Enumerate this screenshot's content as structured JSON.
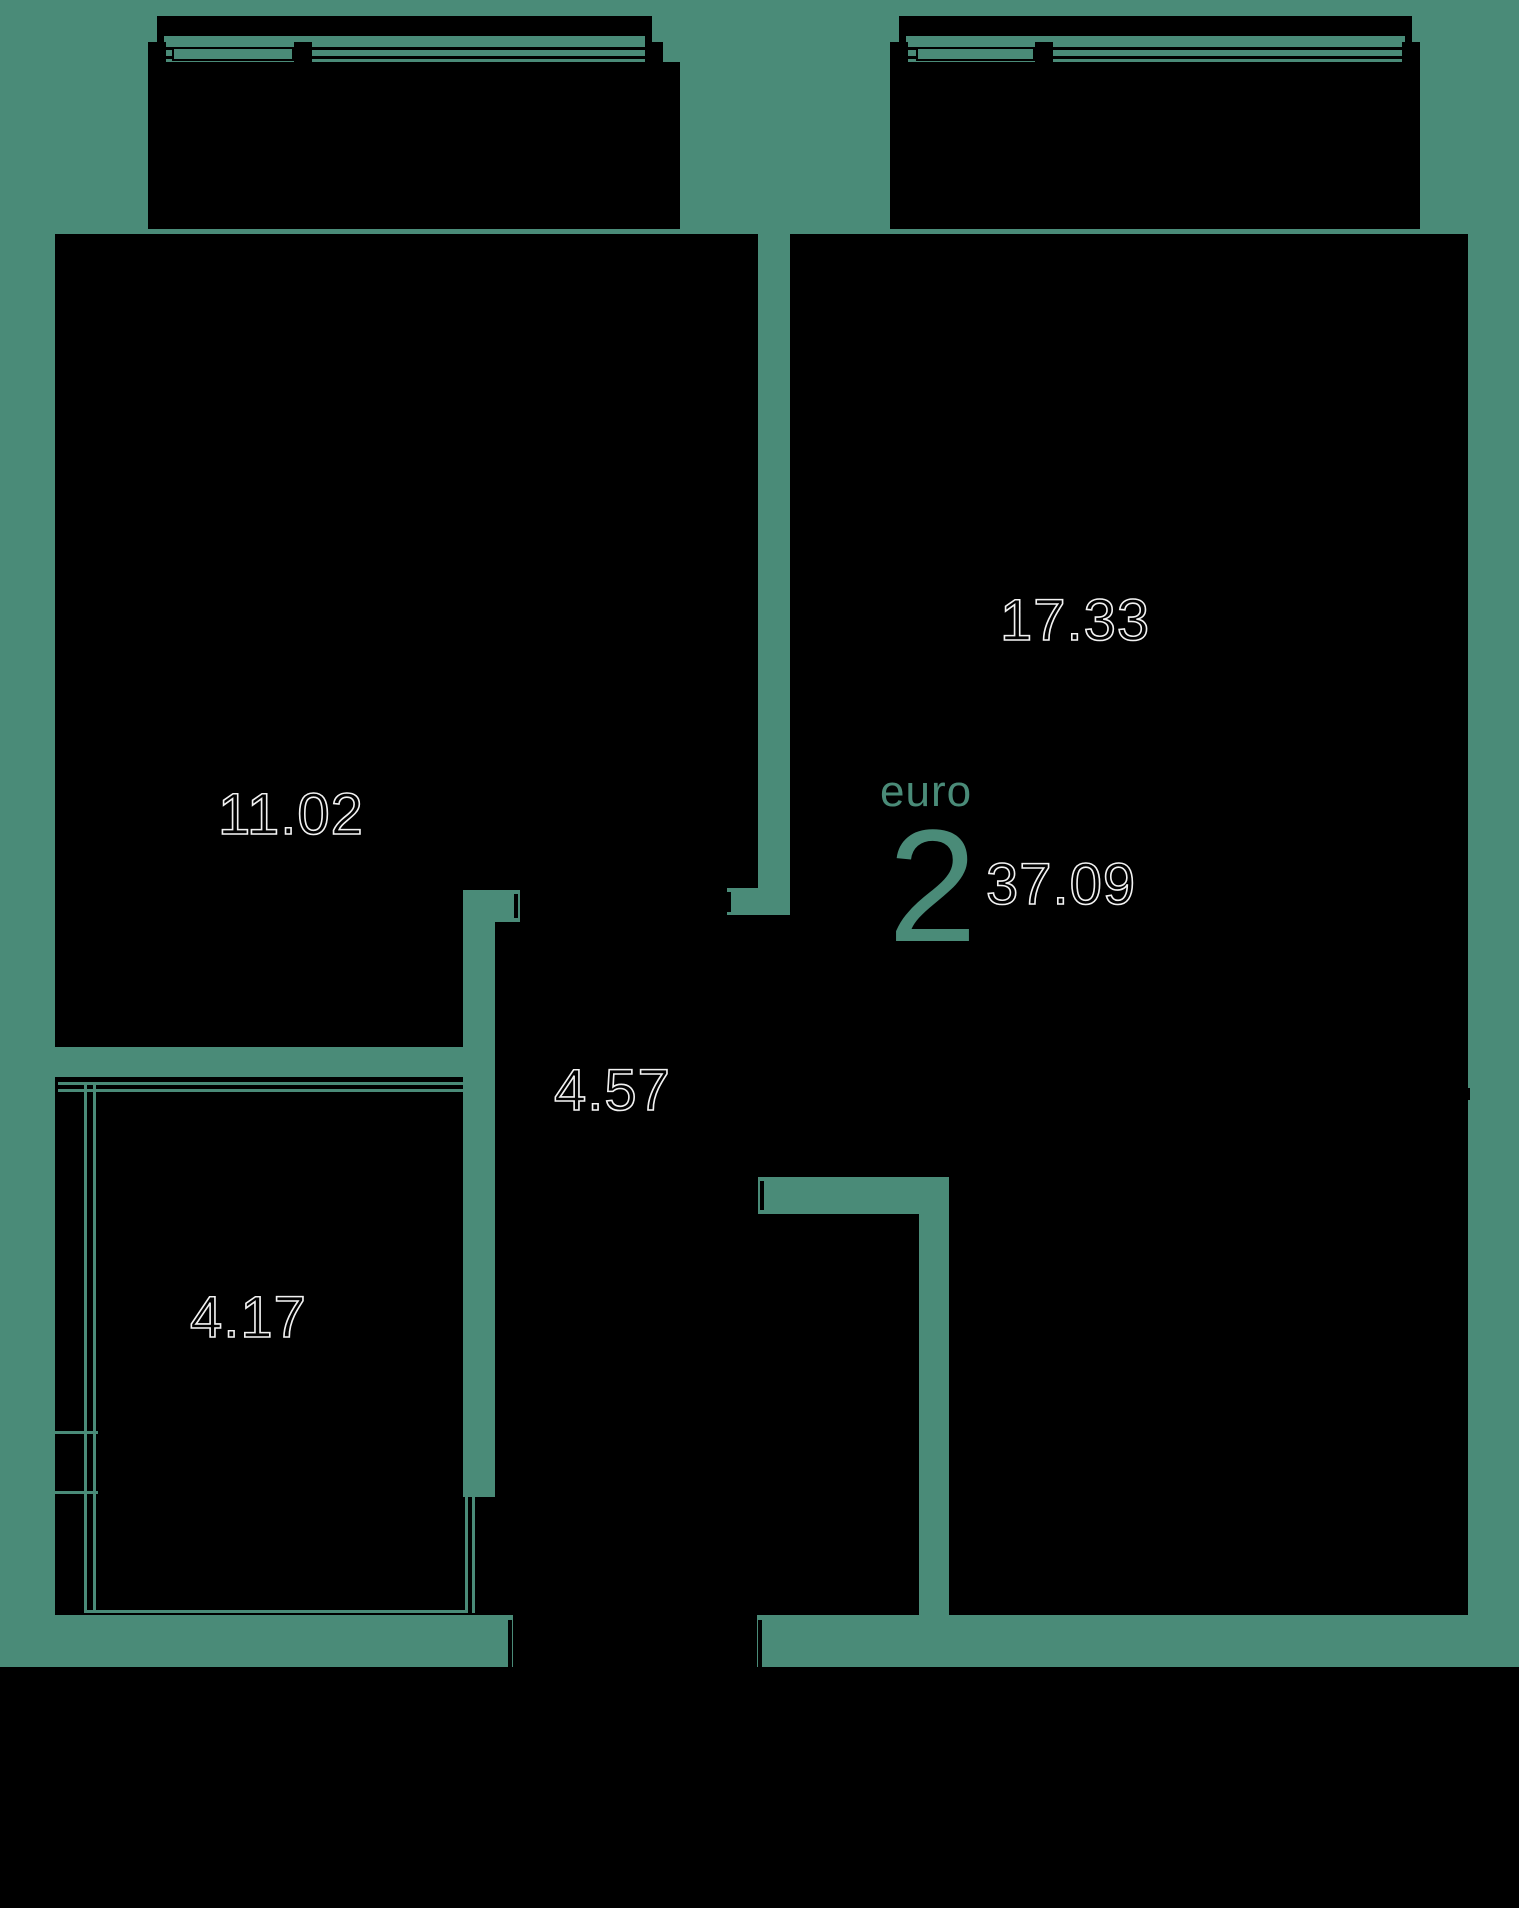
{
  "plan": {
    "unit": {
      "type_label": "euro",
      "rooms_count": "2",
      "total_area": "37.09"
    },
    "rooms": [
      {
        "name": "living-kitchen",
        "area": "17.33"
      },
      {
        "name": "bedroom",
        "area": "11.02"
      },
      {
        "name": "hallway",
        "area": "4.57"
      },
      {
        "name": "bathroom",
        "area": "4.17"
      }
    ],
    "colors": {
      "background": "#4A8B78",
      "room_fill": "#000000",
      "label_outline": "#F2F2F2",
      "accent": "#4A8B78"
    }
  }
}
